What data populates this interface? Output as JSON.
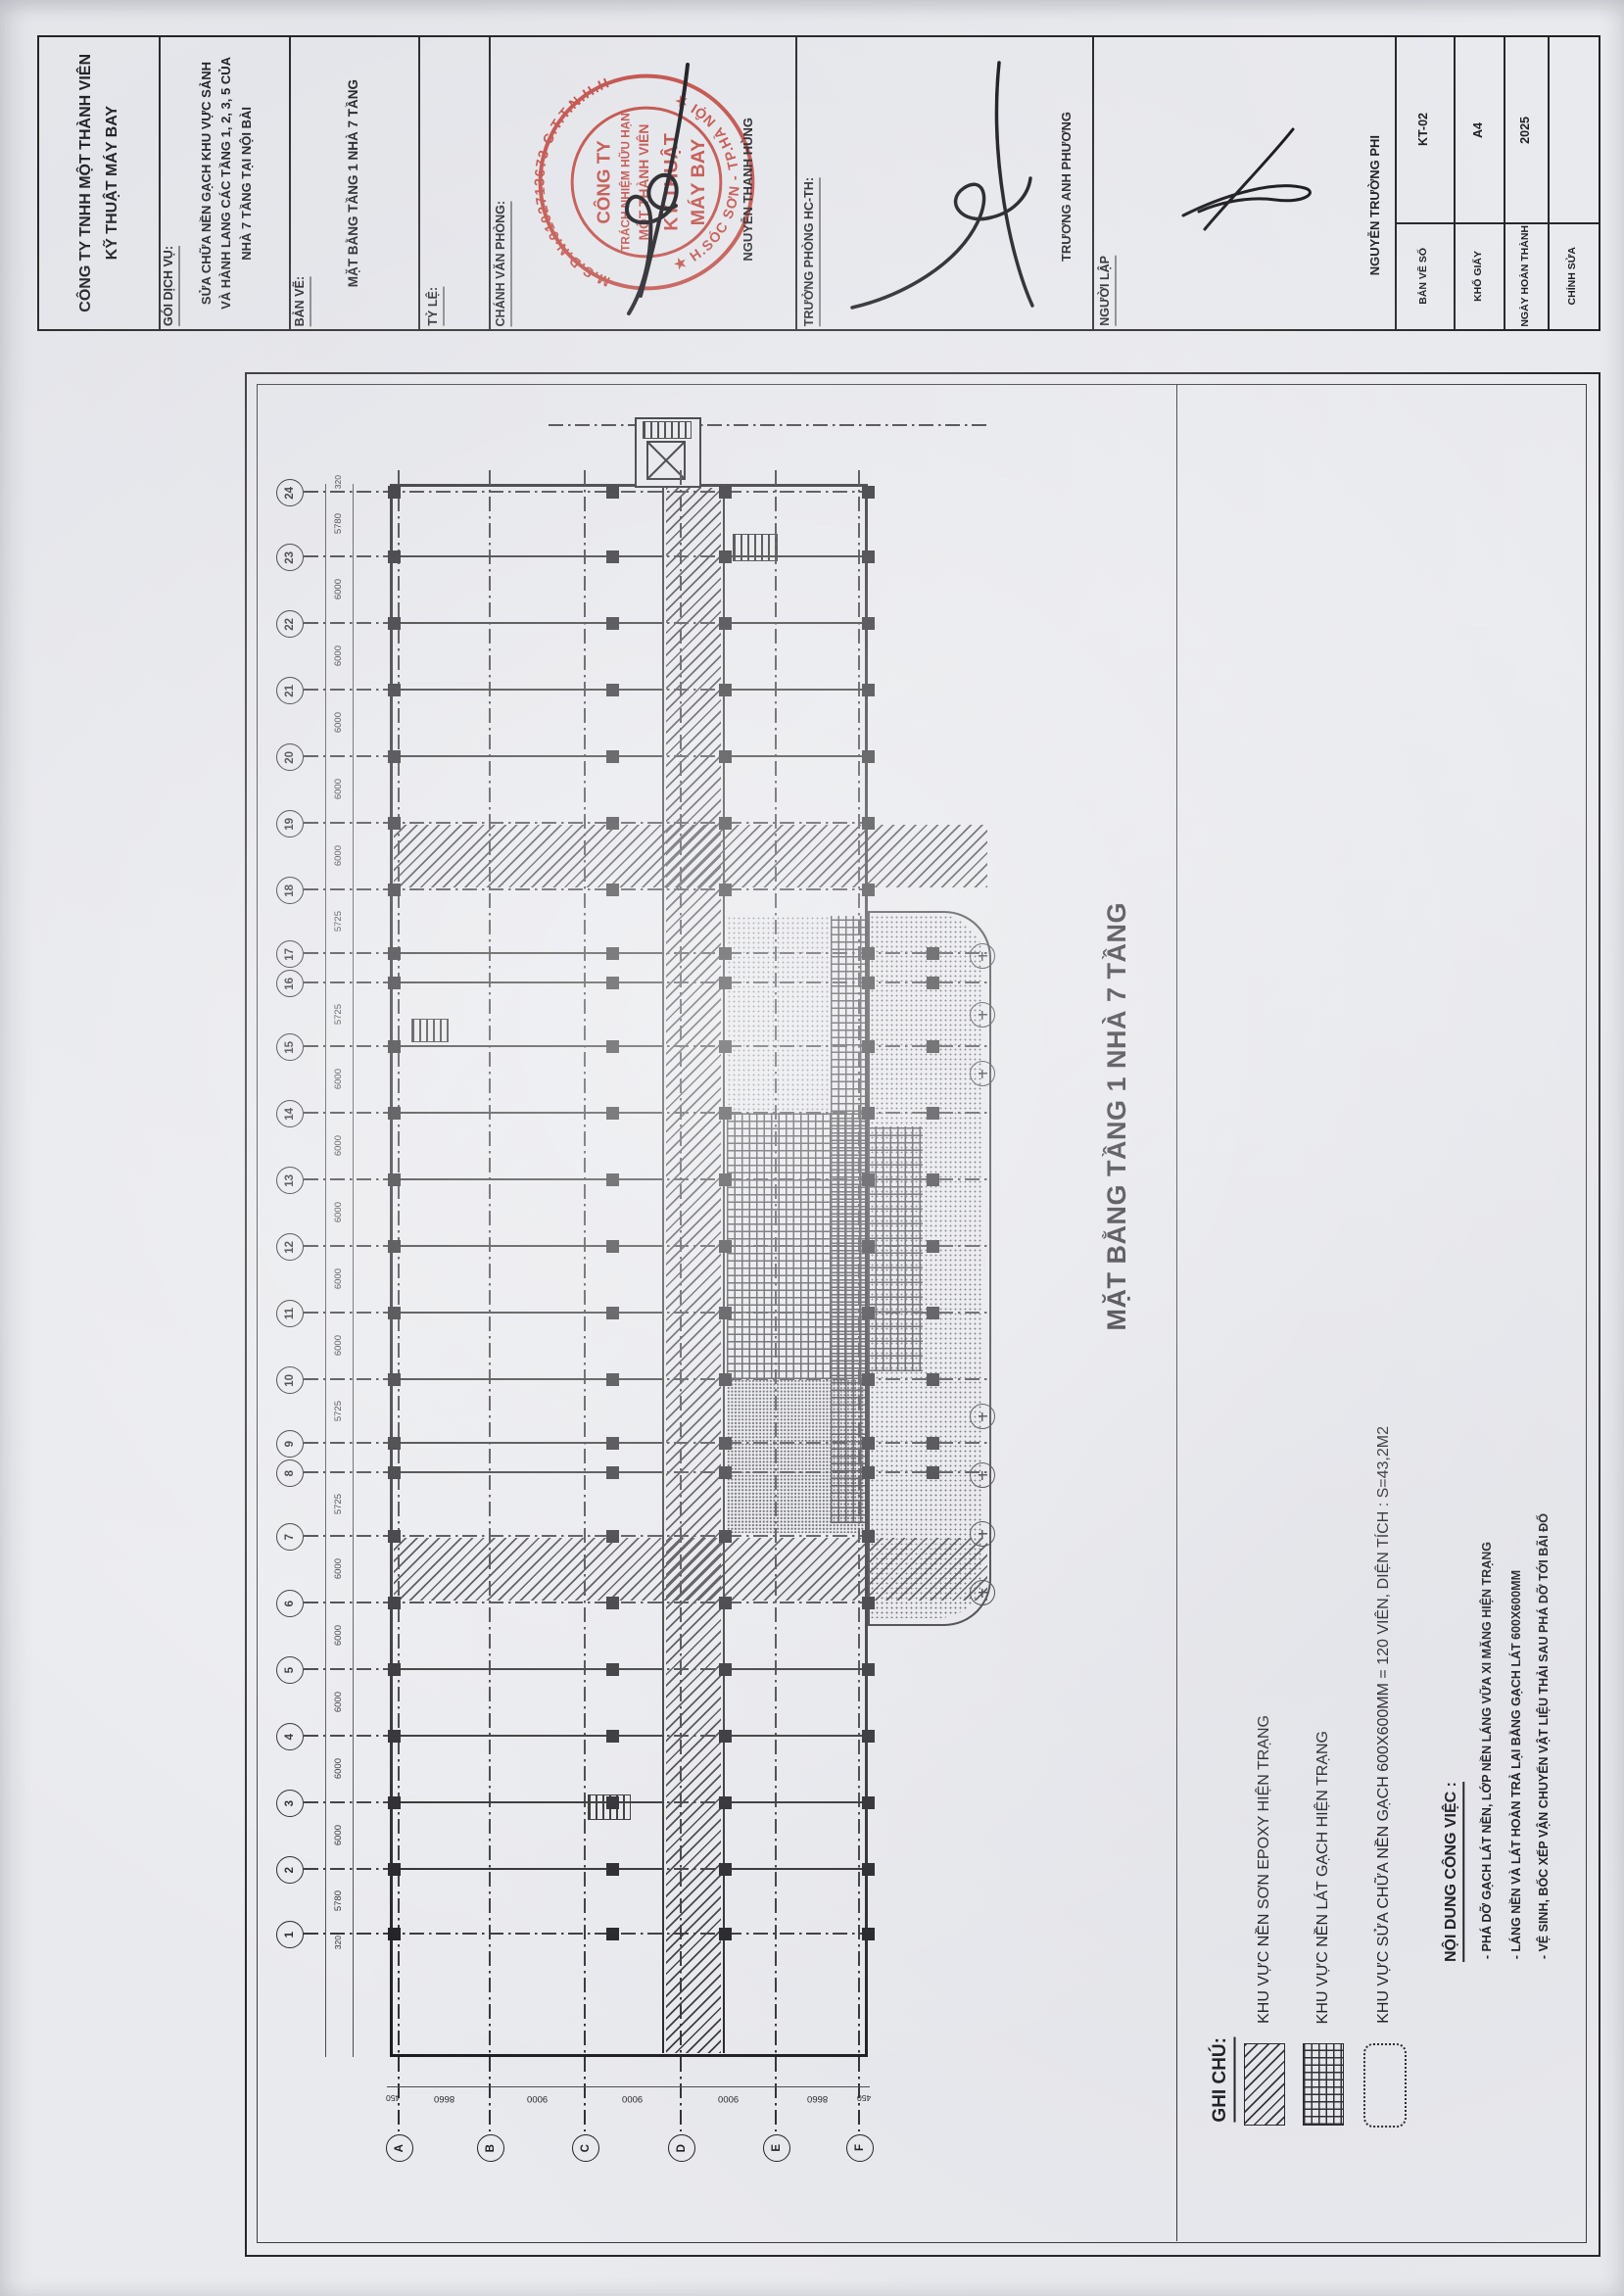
{
  "document": {
    "company_lines": [
      "CÔNG TY TNHH MỘT THÀNH VIÊN",
      "KỸ THUẬT MÁY BAY"
    ],
    "package_label": "GÓI DỊCH VỤ:",
    "package_lines": [
      "SỬA CHỮA NỀN GẠCH KHU VỰC SẢNH",
      "VÀ HÀNH LANG CÁC TẦNG 1, 2, 3, 5 CỦA",
      "NHÀ 7 TẦNG TẠI NỘI BÀI"
    ],
    "drawing_label": "BẢN VẼ:",
    "drawing_name": "MẶT BẰNG TẦNG 1 NHÀ 7 TẦNG",
    "scale_label": "TỶ LỆ:",
    "office_chief_label": "CHÁNH VĂN PHÒNG:",
    "office_chief_name": "NGUYỄN THANH HÙNG",
    "dept_head_label": "TRƯỞNG PHÒNG HC-TH:",
    "dept_head_name": "TRƯƠNG ANH PHƯƠNG",
    "author_label": "NGƯỜI LẬP",
    "author_name": "NGUYỄN TRƯỜNG PHI",
    "meta": [
      {
        "label": "BẢN VẼ SỐ",
        "value": "KT-02"
      },
      {
        "label": "KHỔ GIẤY",
        "value": "A4"
      },
      {
        "label": "NGÀY HOÀN THÀNH",
        "value": "2025"
      },
      {
        "label": "CHỈNH SỬA",
        "value": ""
      }
    ]
  },
  "stamp": {
    "ring_top": "M.S.D.N:0102713673-C.T.T.N.H.H",
    "ring_bottom": "★ H.SÓC SƠN - TP.HÀ NỘI ★",
    "center_lines": [
      "CÔNG TY",
      "TRÁCH NHIỆM HỮU HẠN",
      "MỘT THÀNH VIÊN",
      "KỸ THUẬT",
      "MÁY BAY"
    ],
    "color": "#c03a30"
  },
  "plan": {
    "title": "MẶT BẰNG TẦNG 1 NHÀ 7 TẦNG",
    "row_axis": {
      "labels": [
        "24",
        "23",
        "22",
        "21",
        "20",
        "19",
        "18",
        "17",
        "16",
        "15",
        "14",
        "13",
        "12",
        "11",
        "10",
        "9",
        "8",
        "7",
        "6",
        "5",
        "4",
        "3",
        "2",
        "1"
      ],
      "spans": [
        "5780",
        "6000",
        "6000",
        "6000",
        "6000",
        "6000",
        "5725",
        "",
        "5725",
        "6000",
        "6000",
        "6000",
        "6000",
        "6000",
        "5725",
        "",
        "5725",
        "6000",
        "6000",
        "6000",
        "6000",
        "6000",
        "5780"
      ],
      "end_dim": "320"
    },
    "col_axis": {
      "labels": [
        "A",
        "B",
        "C",
        "D",
        "E",
        "F"
      ],
      "spans": [
        "8660",
        "9000",
        "9000",
        "9000",
        "8660"
      ],
      "end_dim": "450"
    },
    "legend": {
      "title": "GHI CHÚ:",
      "items": [
        {
          "swatch": "hatch-diag",
          "label": "KHU VỰC NỀN SƠN EPOXY HIỆN TRẠNG"
        },
        {
          "swatch": "hatch-grid",
          "label": "KHU VỰC NỀN LÁT GẠCH HIỆN TRẠNG"
        },
        {
          "swatch": "cloud",
          "label": "KHU VỰC SỬA CHỮA NỀN GẠCH 600X600MM = 120 VIÊN, DIỆN TÍCH : S=43,2M2"
        }
      ]
    },
    "notes": {
      "title": "NỘI DUNG CÔNG VIỆC :",
      "items": [
        "- PHÁ DỠ GẠCH LÁT NỀN, LỚP NỀN LÁNG VỮA XI MĂNG HIỆN TRẠNG",
        "- LÁNG NỀN VÀ LÁT HOÀN TRẢ LẠI BẰNG GẠCH LÁT 600X600MM",
        "- VỆ SINH, BỐC XẾP VẬN CHUYỂN VẬT LIỆU THẢI SAU PHÁ DỠ TỚI BÃI ĐỔ"
      ]
    }
  }
}
